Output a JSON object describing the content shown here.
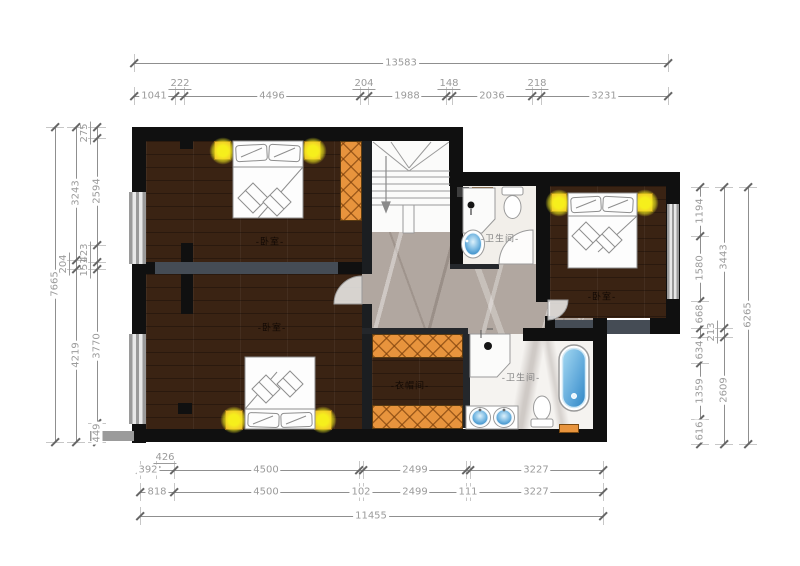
{
  "plan": {
    "rooms": [
      {
        "id": "bedroom-top-left",
        "label": "-卧室-"
      },
      {
        "id": "bedroom-bottom-left",
        "label": "-卧室-"
      },
      {
        "id": "bedroom-right",
        "label": "-卧室-"
      },
      {
        "id": "bathroom-top",
        "label": "-卫生间-"
      },
      {
        "id": "bathroom-bottom",
        "label": "-卫生间-"
      },
      {
        "id": "cloakroom",
        "label": "-衣帽间-"
      }
    ],
    "fixtures": [
      "double-bed",
      "double-bed",
      "double-bed",
      "toilet",
      "toilet",
      "shower",
      "shower",
      "sink",
      "double-sink",
      "bathtub",
      "staircase",
      "wardrobe",
      "nightstand-lamp"
    ],
    "colors": {
      "wood_floor": "#3a2313",
      "wall_black": "#101010",
      "interior_wall_gray": "#454c55",
      "marble_hall": "#b1a7a0",
      "bath_tile": "#f2efea",
      "wardrobe_orange": "#e8943d",
      "lamp_yellow": "#f3ee2a",
      "water_blue": "#2f86c4",
      "dimension_gray": "#9b9b9b"
    }
  },
  "dimensions": {
    "chains": [
      {
        "name": "top-overall",
        "orient": "h",
        "x": 134,
        "y": 63,
        "len": 534,
        "ticks": [
          0,
          534
        ],
        "labels": [
          {
            "t": "13583",
            "at": 267
          }
        ]
      },
      {
        "name": "top-detail",
        "orient": "h",
        "x": 134,
        "y": 96,
        "len": 534,
        "ticks": [
          0,
          41,
          50,
          226,
          234,
          312,
          318,
          398,
          407,
          534
        ],
        "labels": [
          {
            "t": "1041",
            "at": 20
          },
          {
            "t": "222",
            "at": 46,
            "raised": true
          },
          {
            "t": "4496",
            "at": 138
          },
          {
            "t": "204",
            "at": 230,
            "raised": true
          },
          {
            "t": "1988",
            "at": 273
          },
          {
            "t": "148",
            "at": 315,
            "raised": true
          },
          {
            "t": "2036",
            "at": 358
          },
          {
            "t": "218",
            "at": 403,
            "raised": true
          },
          {
            "t": "3231",
            "at": 470
          }
        ]
      },
      {
        "name": "left-overall",
        "orient": "v",
        "x": 55,
        "y": 127,
        "len": 315,
        "ticks": [
          0,
          315
        ],
        "labels": [
          {
            "t": "7665",
            "at": 157
          }
        ]
      },
      {
        "name": "left-mid",
        "orient": "v",
        "x": 76,
        "y": 127,
        "len": 315,
        "ticks": [
          0,
          133,
          142,
          315
        ],
        "labels": [
          {
            "t": "3243",
            "at": 66
          },
          {
            "t": "204",
            "at": 137,
            "raised": true
          },
          {
            "t": "4219",
            "at": 228
          }
        ]
      },
      {
        "name": "left-detail",
        "orient": "v",
        "x": 97,
        "y": 127,
        "len": 315,
        "ticks": [
          0,
          11,
          118,
          135,
          142,
          296,
          315
        ],
        "labels": [
          {
            "t": "275",
            "at": 6,
            "raised": true
          },
          {
            "t": "2594",
            "at": 64
          },
          {
            "t": "423",
            "at": 126,
            "raised": true
          },
          {
            "t": "151",
            "at": 140,
            "raised": true
          },
          {
            "t": "3770",
            "at": 219
          },
          {
            "t": "449",
            "at": 306
          }
        ]
      },
      {
        "name": "right-detail",
        "orient": "v",
        "x": 700,
        "y": 187,
        "len": 257,
        "ticks": [
          0,
          49,
          114,
          141,
          150,
          176,
          232,
          257
        ],
        "labels": [
          {
            "t": "1194",
            "at": 24
          },
          {
            "t": "1580",
            "at": 81
          },
          {
            "t": "668",
            "at": 127
          },
          {
            "t": "634",
            "at": 163
          },
          {
            "t": "1359",
            "at": 204
          },
          {
            "t": "616",
            "at": 244
          }
        ]
      },
      {
        "name": "right-mid",
        "orient": "v",
        "x": 724,
        "y": 187,
        "len": 257,
        "ticks": [
          0,
          141,
          150,
          257
        ],
        "labels": [
          {
            "t": "3443",
            "at": 70
          },
          {
            "t": "213",
            "at": 145,
            "raised": true
          },
          {
            "t": "2609",
            "at": 203
          }
        ]
      },
      {
        "name": "right-overall",
        "orient": "v",
        "x": 748,
        "y": 187,
        "len": 257,
        "ticks": [
          0,
          257
        ],
        "labels": [
          {
            "t": "6265",
            "at": 128
          }
        ]
      },
      {
        "name": "bottom-detail-1",
        "orient": "h",
        "x": 140,
        "y": 470,
        "len": 463,
        "ticks": [
          0,
          16,
          34,
          219,
          223,
          326,
          330,
          463
        ],
        "labels": [
          {
            "t": "392",
            "at": 8
          },
          {
            "t": "426",
            "at": 25,
            "raised": true
          },
          {
            "t": "4500",
            "at": 126
          },
          {
            "t": "2499",
            "at": 275
          },
          {
            "t": "3227",
            "at": 396
          }
        ]
      },
      {
        "name": "bottom-detail-2",
        "orient": "h",
        "x": 140,
        "y": 492,
        "len": 463,
        "ticks": [
          0,
          34,
          219,
          223,
          326,
          330,
          463
        ],
        "labels": [
          {
            "t": "818",
            "at": 17
          },
          {
            "t": "4500",
            "at": 126
          },
          {
            "t": "102",
            "at": 221
          },
          {
            "t": "2499",
            "at": 275
          },
          {
            "t": "111",
            "at": 328
          },
          {
            "t": "3227",
            "at": 396
          }
        ]
      },
      {
        "name": "bottom-overall",
        "orient": "h",
        "x": 140,
        "y": 516,
        "len": 463,
        "ticks": [
          0,
          463
        ],
        "labels": [
          {
            "t": "11455",
            "at": 231
          }
        ]
      }
    ]
  }
}
